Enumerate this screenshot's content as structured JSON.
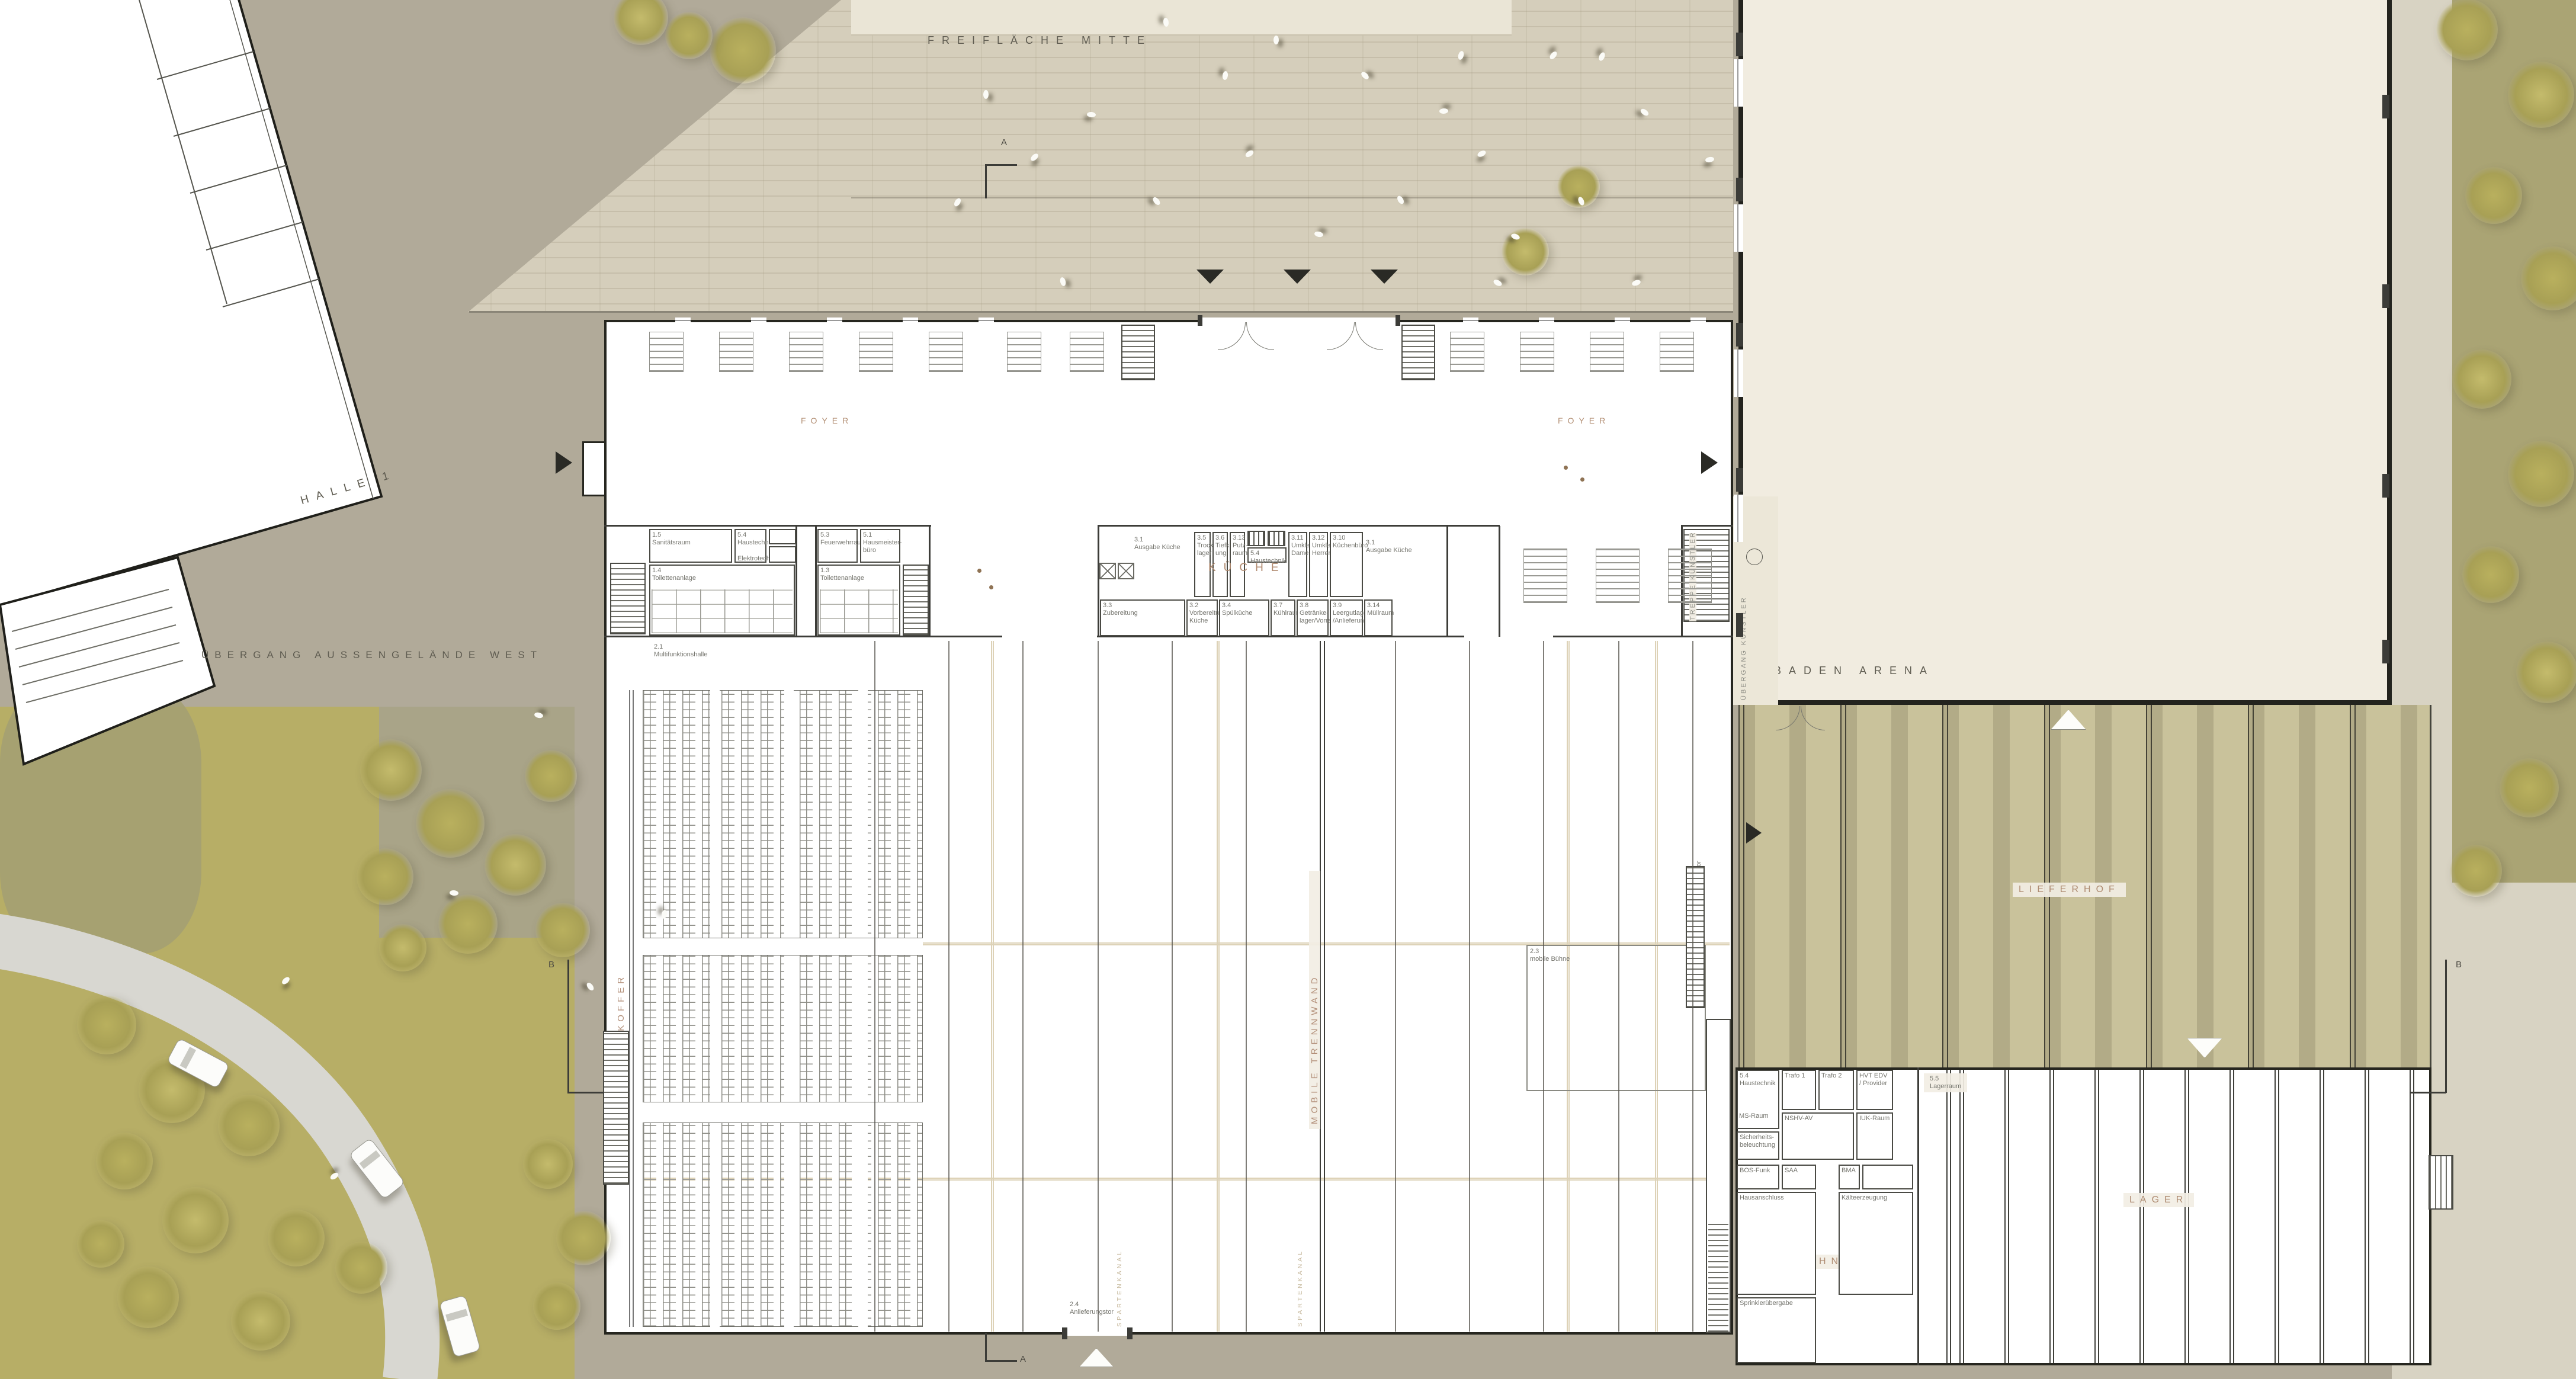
{
  "colors": {
    "accent_brown": "#ae8b71",
    "ink": "#5f5c51",
    "ground": "#b1aa99",
    "plaza": "#d5cebb",
    "lawn": "#b7ae66",
    "lieferhof": "#c9c29b",
    "arena_fill": "#f1ece0"
  },
  "site": {
    "plaza_label": "FREIFLÄCHE MITTE",
    "west_passage_label": "ÜBERGANG AUSSENGELÄNDE WEST",
    "halle1_label": "HALLE 1",
    "arena_label": "BADEN ARENA",
    "delivery_yard_label": "LIEFERHOF",
    "artist_passage_label": "ÜBERGANG KÜNSTLER",
    "artist_stair_label": "TREPPE KÜNSTLER",
    "section_a": "A",
    "section_b": "B"
  },
  "foyer": {
    "label_left": "FOYER",
    "label_right": "FOYER"
  },
  "west_rooms": {
    "r15": {
      "id": "1.5",
      "name": "Sanitätsraum"
    },
    "r54": {
      "id": "5.4",
      "name": "Haustechnik",
      "name2": "Elektrotechnik"
    },
    "r53": {
      "id": "5.3",
      "name": "Feuerwehrraum"
    },
    "r51": {
      "id": "5.1",
      "name": "Hausmeister-büro"
    },
    "r14": {
      "id": "1.4",
      "name": "Toilettenanlage"
    },
    "r13": {
      "id": "1.3",
      "name": "Toilettenanlage"
    }
  },
  "kitchen": {
    "label": "KÜCHE",
    "ausgabe_left": {
      "id": "3.1",
      "name": "Ausgabe Küche"
    },
    "ausgabe_right": {
      "id": "3.1",
      "name": "Ausgabe Küche"
    },
    "trockenlager": {
      "id": "3.5",
      "name": "Trocken-lager"
    },
    "tiefkuehlung": {
      "id": "3.6",
      "name": "Tiefkühl-ung"
    },
    "putzraum": {
      "id": "3.13",
      "name": "Putz-raum"
    },
    "haustechnik": {
      "id": "5.4",
      "name": "Haustechnik"
    },
    "umkleide_damen": {
      "id": "3.11",
      "name": "Umkleide Damen"
    },
    "umkleide_herren": {
      "id": "3.12",
      "name": "Umkleide Herren"
    },
    "kuechenbuero": {
      "id": "3.10",
      "name": "Küchenbüro"
    },
    "zubereitung": {
      "id": "3.3",
      "name": "Zubereitung"
    },
    "vorbereitung": {
      "id": "3.2",
      "name": "Vorbereitung Küche"
    },
    "spuelkueche": {
      "id": "3.4",
      "name": "Spülküche"
    },
    "kuehlraum": {
      "id": "3.7",
      "name": "Kühlraum"
    },
    "getraenkelager": {
      "id": "3.8",
      "name": "Getränke-lager/Vorrat"
    },
    "leergutlager": {
      "id": "3.9",
      "name": "Leergutlager /Anlieferung"
    },
    "muellraum": {
      "id": "3.14",
      "name": "Müllraum"
    }
  },
  "hall": {
    "id": "2.1",
    "name": "Multifunktionshalle",
    "stage_id": "2.3",
    "stage_name": "mobile Bühne",
    "gate_south_id": "2.4",
    "gate_south_name": "Anlieferungstor",
    "gate_east_id": "2.4",
    "gate_east_name": "Anlieferungstor",
    "wandkoffer": "WANDKOFFER",
    "mobile_trennwand": "MOBILE TRENNWAND",
    "spartenkanal": "SPARTENKANAL"
  },
  "technik": {
    "label": "TECHNIK",
    "haustechnik": {
      "id": "5.4",
      "name": "Haustechnik"
    },
    "ms_raum": "MS-Raum",
    "sicherheitsbeleuchtung": "Sicherheits-beleuchtung",
    "trafo1": "Trafo 1",
    "trafo2": "Trafo 2",
    "hvt": "HVT EDV / Provider",
    "nshv": "NSHV-AV",
    "iuk": "IUK-Raum",
    "bos_funk": "BOS-Funk",
    "saa": "SAA",
    "bma": "BMA",
    "hausanschluss": "Hausanschluss",
    "kaelteerzeugung": "Kälteerzeugung",
    "sprinkleruebergabe": "Sprinklerübergabe"
  },
  "lager": {
    "label": "LAGER",
    "lagerraum": {
      "id": "5.5",
      "name": "Lagerraum"
    }
  }
}
